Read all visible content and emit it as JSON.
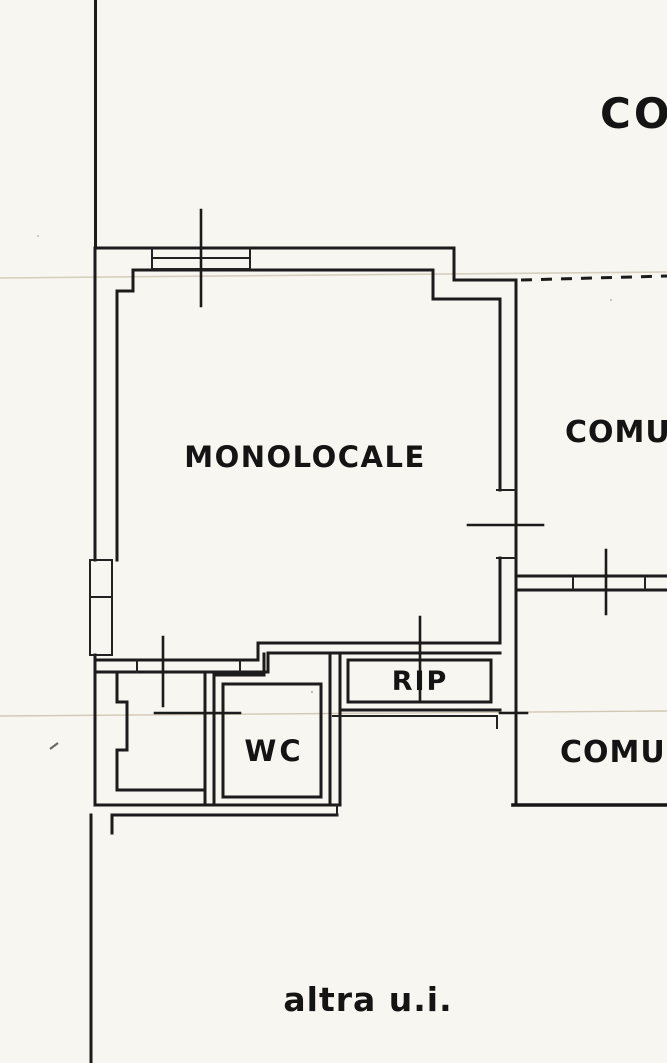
{
  "document": {
    "kind": "scanned floor plan (planimetria)",
    "unit_note": "single-room apartment plan with common areas"
  },
  "labels": {
    "top_right_partial": "CO",
    "room_main": "MONOLOCALE",
    "common_area_upper_partial": "COMUN",
    "room_storage": "RIP",
    "room_wc": "WC",
    "common_area_lower_partial": "COMUN",
    "bottom_caption": "altra u.i."
  },
  "colors": {
    "ink": "#1b1b1b",
    "paper": "#f7f6f1",
    "scan_artifact": "#cfc8b4"
  }
}
